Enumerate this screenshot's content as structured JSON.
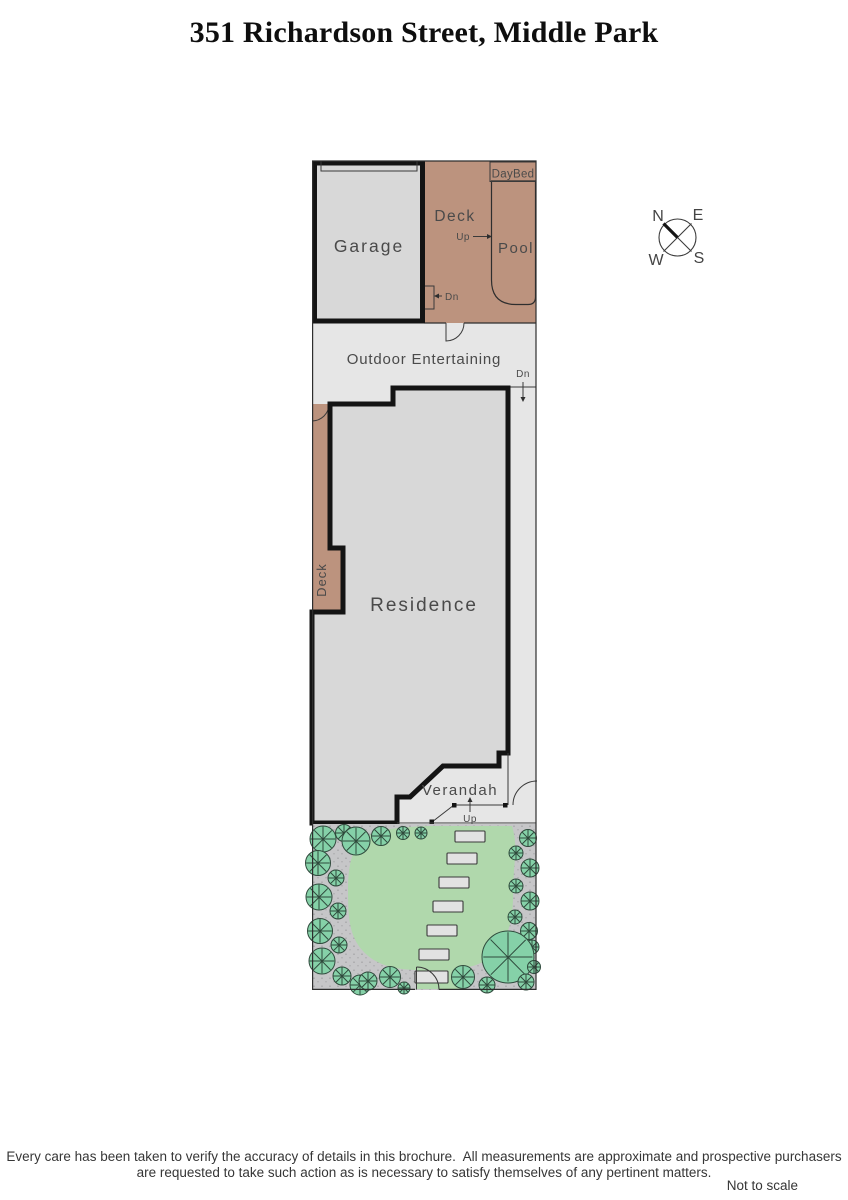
{
  "title": "351 Richardson Street, Middle Park",
  "plan": {
    "labels": {
      "garage": "Garage",
      "deck_top": "Deck",
      "pool": "Pool",
      "daybed": "DayBed",
      "outdoor_entertaining": "Outdoor Entertaining",
      "residence": "Residence",
      "deck_side": "Deck",
      "verandah": "Verandah"
    },
    "stairs": {
      "up_pool": "Up",
      "dn_deck": "Dn",
      "dn_path": "Dn",
      "up_verandah": "Up"
    }
  },
  "compass": {
    "north": "N",
    "east": "E",
    "south": "S",
    "west": "W"
  },
  "footer": {
    "disclaimer_line1": "Every care has been taken to verify the accuracy of details in this brochure.  All measurements are approximate and prospective purchasers",
    "disclaimer_line2": "are requested to take such action as is necessary to satisfy themselves of any pertinent matters.",
    "scale_note": "Not to scale"
  },
  "colors": {
    "deck": "#bc937e",
    "pool": "#cbe9f8",
    "building": "#d8d8d8",
    "paving": "#e6e6e6",
    "garden_ground": "#c6c6c8",
    "garden_dot": "#a4a4a6",
    "lawn": "#b0d8ac",
    "tree": "#85d1a8",
    "daybed_fill": "#dcdcdc"
  }
}
